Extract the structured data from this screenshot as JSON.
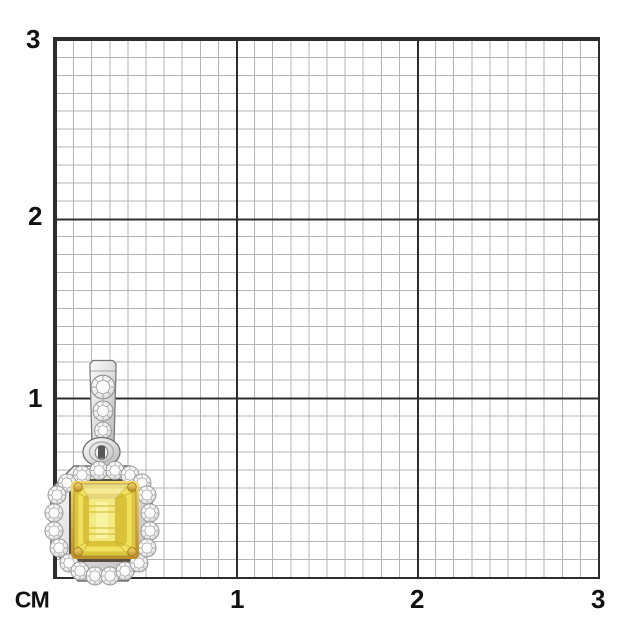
{
  "ruler": {
    "unit_label": "СМ",
    "y_axis_labels": [
      "3",
      "2",
      "1"
    ],
    "x_axis_labels": [
      "1",
      "2",
      "3"
    ]
  },
  "grid": {
    "background": "#ffffff",
    "minor_line_color": "#b4b4b4",
    "major_line_color": "#2d2d2d",
    "cm_count": 3,
    "mm_per_cm": 10
  },
  "pendant": {
    "name": "yellow-stone-halo-pendant",
    "center_stone_shape": "emerald-cut",
    "center_stone_color": "#e9d74e",
    "halo_stone_count": 20,
    "bail_stone_count": 4,
    "metal_color": "#d6d6d6",
    "gold_accent_color": "#d9a83c",
    "approx_width_cm": 0.6,
    "approx_height_cm": 1.25
  }
}
